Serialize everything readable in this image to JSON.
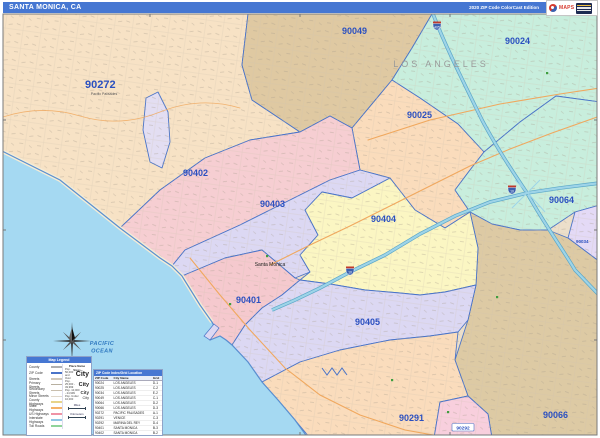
{
  "title_bar": {
    "title": "SANTA MONICA, CA",
    "edition": "2020 ZIP Code ColorCast Edition",
    "logo_brand": "MAPS"
  },
  "colors": {
    "title_bar_bg": "#4677d2",
    "zip_label": "#2b50c0",
    "zip_boundary": "#4a74c8",
    "ocean": "#a5d9f2",
    "freeway": "#9ed4e8",
    "major_road": "#f0a85e",
    "park_green": "#3f9e3f"
  },
  "map": {
    "region_fills": {
      "90272": "#f7e2c5",
      "90049": "#dfc9a2",
      "90024": "#c8eedd",
      "90025": "#fadcbc",
      "90064": "#c8eedd",
      "90034": "#e4daf6",
      "90066": "#ddcaa4",
      "90402": "#f6ced2",
      "90403": "#dcd8f3",
      "90404": "#fbf6c3",
      "90401": "#f5c9ce",
      "90405": "#dcd8f3",
      "90291": "#fadcbc",
      "90292": "#f8cfdd",
      "lagoon": "#e3def2",
      "ocean": "#a5d9f2"
    },
    "zips": [
      {
        "code": "90272"
      },
      {
        "code": "90049"
      },
      {
        "code": "90024"
      },
      {
        "code": "90025"
      },
      {
        "code": "90402"
      },
      {
        "code": "90403"
      },
      {
        "code": "90404"
      },
      {
        "code": "90401"
      },
      {
        "code": "90405"
      },
      {
        "code": "90064"
      },
      {
        "code": "90034"
      },
      {
        "code": "90066"
      },
      {
        "code": "90291"
      },
      {
        "code": "90292"
      }
    ],
    "labels": {
      "los_angeles": "LOS ANGELES",
      "santa_monica": "Santa Monica",
      "pacific_palisades": "Pacific Palisades",
      "ocean_line1": "PACIFIC",
      "ocean_line2": "OCEAN"
    },
    "shields": [
      {
        "num": "405"
      },
      {
        "num": "10"
      },
      {
        "num": "10"
      }
    ]
  },
  "legend": {
    "header": "Map Legend",
    "items": [
      {
        "label": "County",
        "swatch": "background:#b0b0b0"
      },
      {
        "label": "ZIP Code",
        "swatch": "background:#4a74c8"
      },
      {
        "label": "Streets",
        "swatch": "background:#d0c8ba"
      },
      {
        "label": "Primary Streets",
        "swatch": "background:#b8b0a0"
      },
      {
        "label": "Secondary Streets",
        "swatch": "background:#c9bfae"
      },
      {
        "label": "Minor Streets",
        "swatch": "background:#e0d8ca"
      },
      {
        "label": "County Highways",
        "swatch": "background:#e8d48a"
      },
      {
        "label": "State Highways",
        "swatch": "background:#f5b26a"
      },
      {
        "label": "US Highways",
        "swatch": "background:#ef93a5"
      },
      {
        "label": "Interstate Highways",
        "swatch": "background:#8fc7e4"
      },
      {
        "label": "Toll Roads",
        "swatch": "background:#8fd49a"
      }
    ],
    "place_names": {
      "header": "Place Name Sizes",
      "classes": [
        {
          "pop": "Pop. 50,000 and Over",
          "sample": "City"
        },
        {
          "pop": "Pop. 25,000 - 49,999",
          "sample": "City"
        },
        {
          "pop": "Pop. 10,000 - 24,999",
          "sample": "City"
        },
        {
          "pop": "Pop. Under 10,000",
          "sample": "City"
        }
      ]
    },
    "scale": {
      "miles": "Miles",
      "kilometers": "Kilometers"
    }
  },
  "zip_table": {
    "header": "ZIP Code Index/Grid Location",
    "columns": [
      "ZIP Code",
      "City Name",
      "Grid"
    ],
    "rows": [
      {
        "zip": "90024",
        "city": "LOS ANGELES",
        "grid": "D-1"
      },
      {
        "zip": "90025",
        "city": "LOS ANGELES",
        "grid": "C-2"
      },
      {
        "zip": "90034",
        "city": "LOS ANGELES",
        "grid": "E-2"
      },
      {
        "zip": "90049",
        "city": "LOS ANGELES",
        "grid": "C-1"
      },
      {
        "zip": "90064",
        "city": "LOS ANGELES",
        "grid": "D-2"
      },
      {
        "zip": "90066",
        "city": "LOS ANGELES",
        "grid": "D-3"
      },
      {
        "zip": "90272",
        "city": "PACIFIC PALISADES",
        "grid": "A-1"
      },
      {
        "zip": "90291",
        "city": "VENICE",
        "grid": "C-3"
      },
      {
        "zip": "90292",
        "city": "MARINA DEL REY",
        "grid": "D-4"
      },
      {
        "zip": "90401",
        "city": "SANTA MONICA",
        "grid": "B-3"
      },
      {
        "zip": "90402",
        "city": "SANTA MONICA",
        "grid": "B-2"
      },
      {
        "zip": "90403",
        "city": "SANTA MONICA",
        "grid": "B-2"
      },
      {
        "zip": "90404",
        "city": "SANTA MONICA",
        "grid": "C-2"
      },
      {
        "zip": "90405",
        "city": "SANTA MONICA",
        "grid": "C-3"
      }
    ]
  }
}
